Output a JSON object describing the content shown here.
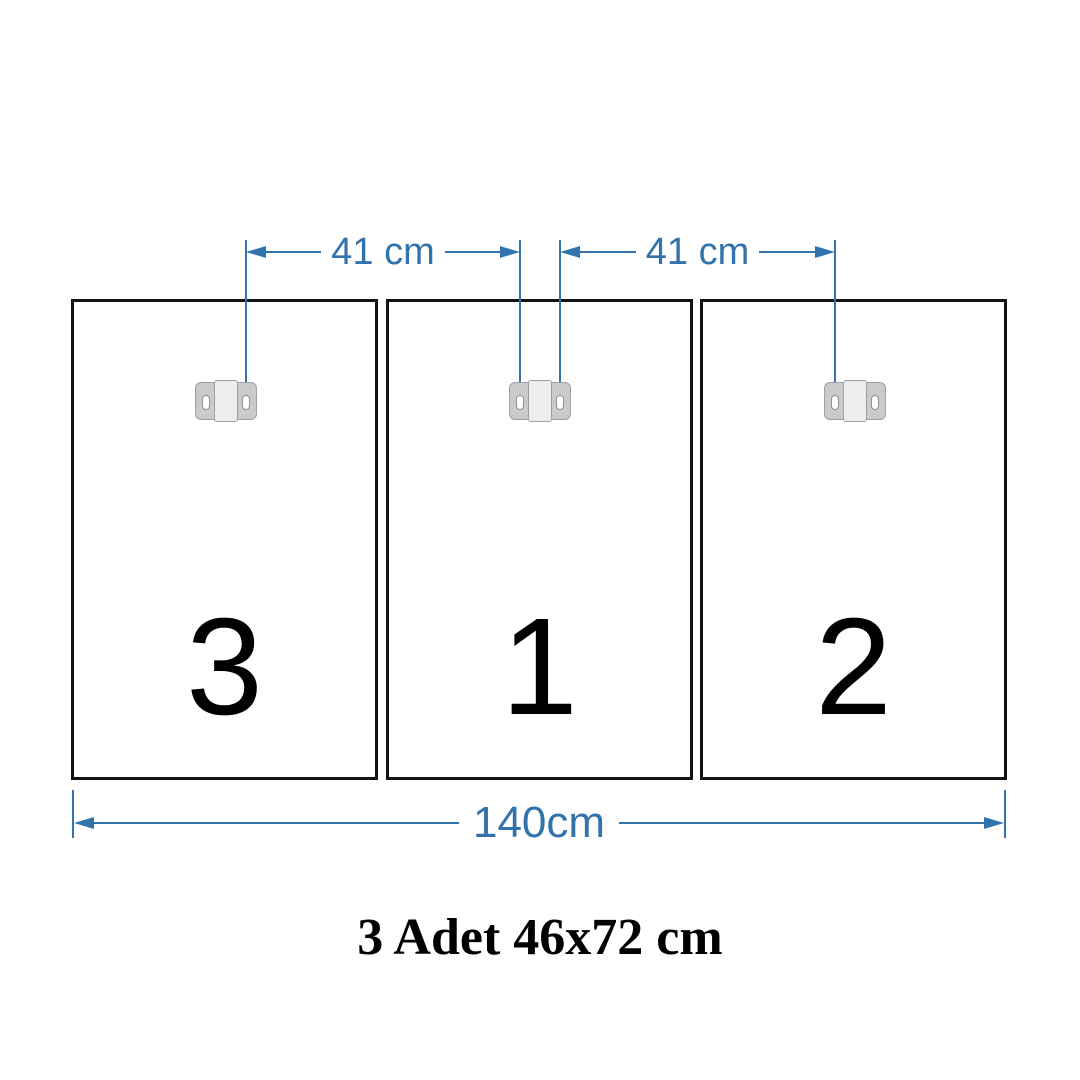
{
  "diagram": {
    "caption": "3 Adet 46x72 cm",
    "total_width_label": "140cm",
    "spacing_labels": [
      "41 cm",
      "41 cm"
    ],
    "panel_numbers": [
      "3",
      "1",
      "2"
    ]
  },
  "colors": {
    "dimension_blue": "#3273ad",
    "panel_border_black": "#131313",
    "panel_number_black": "#000000",
    "bracket_gray": "#c9cacb",
    "bracket_border_gray": "#9fa0a2",
    "bracket_center_gray": "#ededee",
    "bracket_slot_white": "#ffffff",
    "background_white": "#ffffff"
  }
}
